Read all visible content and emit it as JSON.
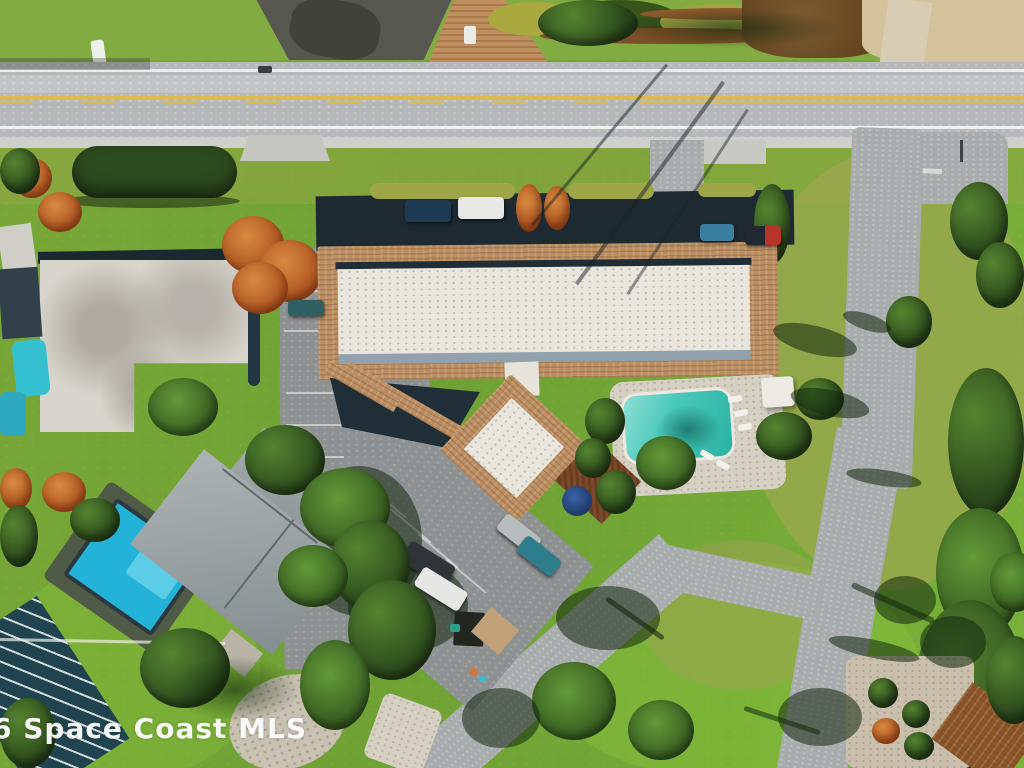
{
  "image_type": "aerial-drone-photograph",
  "watermark": {
    "text": "6 Space Coast MLS",
    "color": "#ffffff"
  },
  "scene": {
    "summary": "Overhead aerial view of a long condominium building with white flat roof and brown shingle mansard edges, an attached diamond-shaped wing, community swimming pool with sun deck, shaded parking rows with cars, a neighboring house with gray hip roof and bright blue pool, lawns, palm trees, a main highway with double yellow line, and side streets",
    "palette": {
      "grass": "#74a636",
      "bright_lawn": "#80b53c",
      "dry_grass": "#a09f5e",
      "highway_asphalt": "#b6b8b9",
      "side_street": "#a9acad",
      "lane_line_yellow": "#ddbb4e",
      "shingle_brown": "#bb8f63",
      "roof_white": "#e9e6de",
      "parapet_gray": "#91a2ae",
      "parking_shadow": "#1d2a32",
      "pool_teal": "#36c0b0",
      "residential_pool_blue": "#28b6dc",
      "house_roof_gray": "#9aa2a4",
      "deck_concrete": "#d6d0c3",
      "paver_tan": "#c9c1b2"
    }
  }
}
